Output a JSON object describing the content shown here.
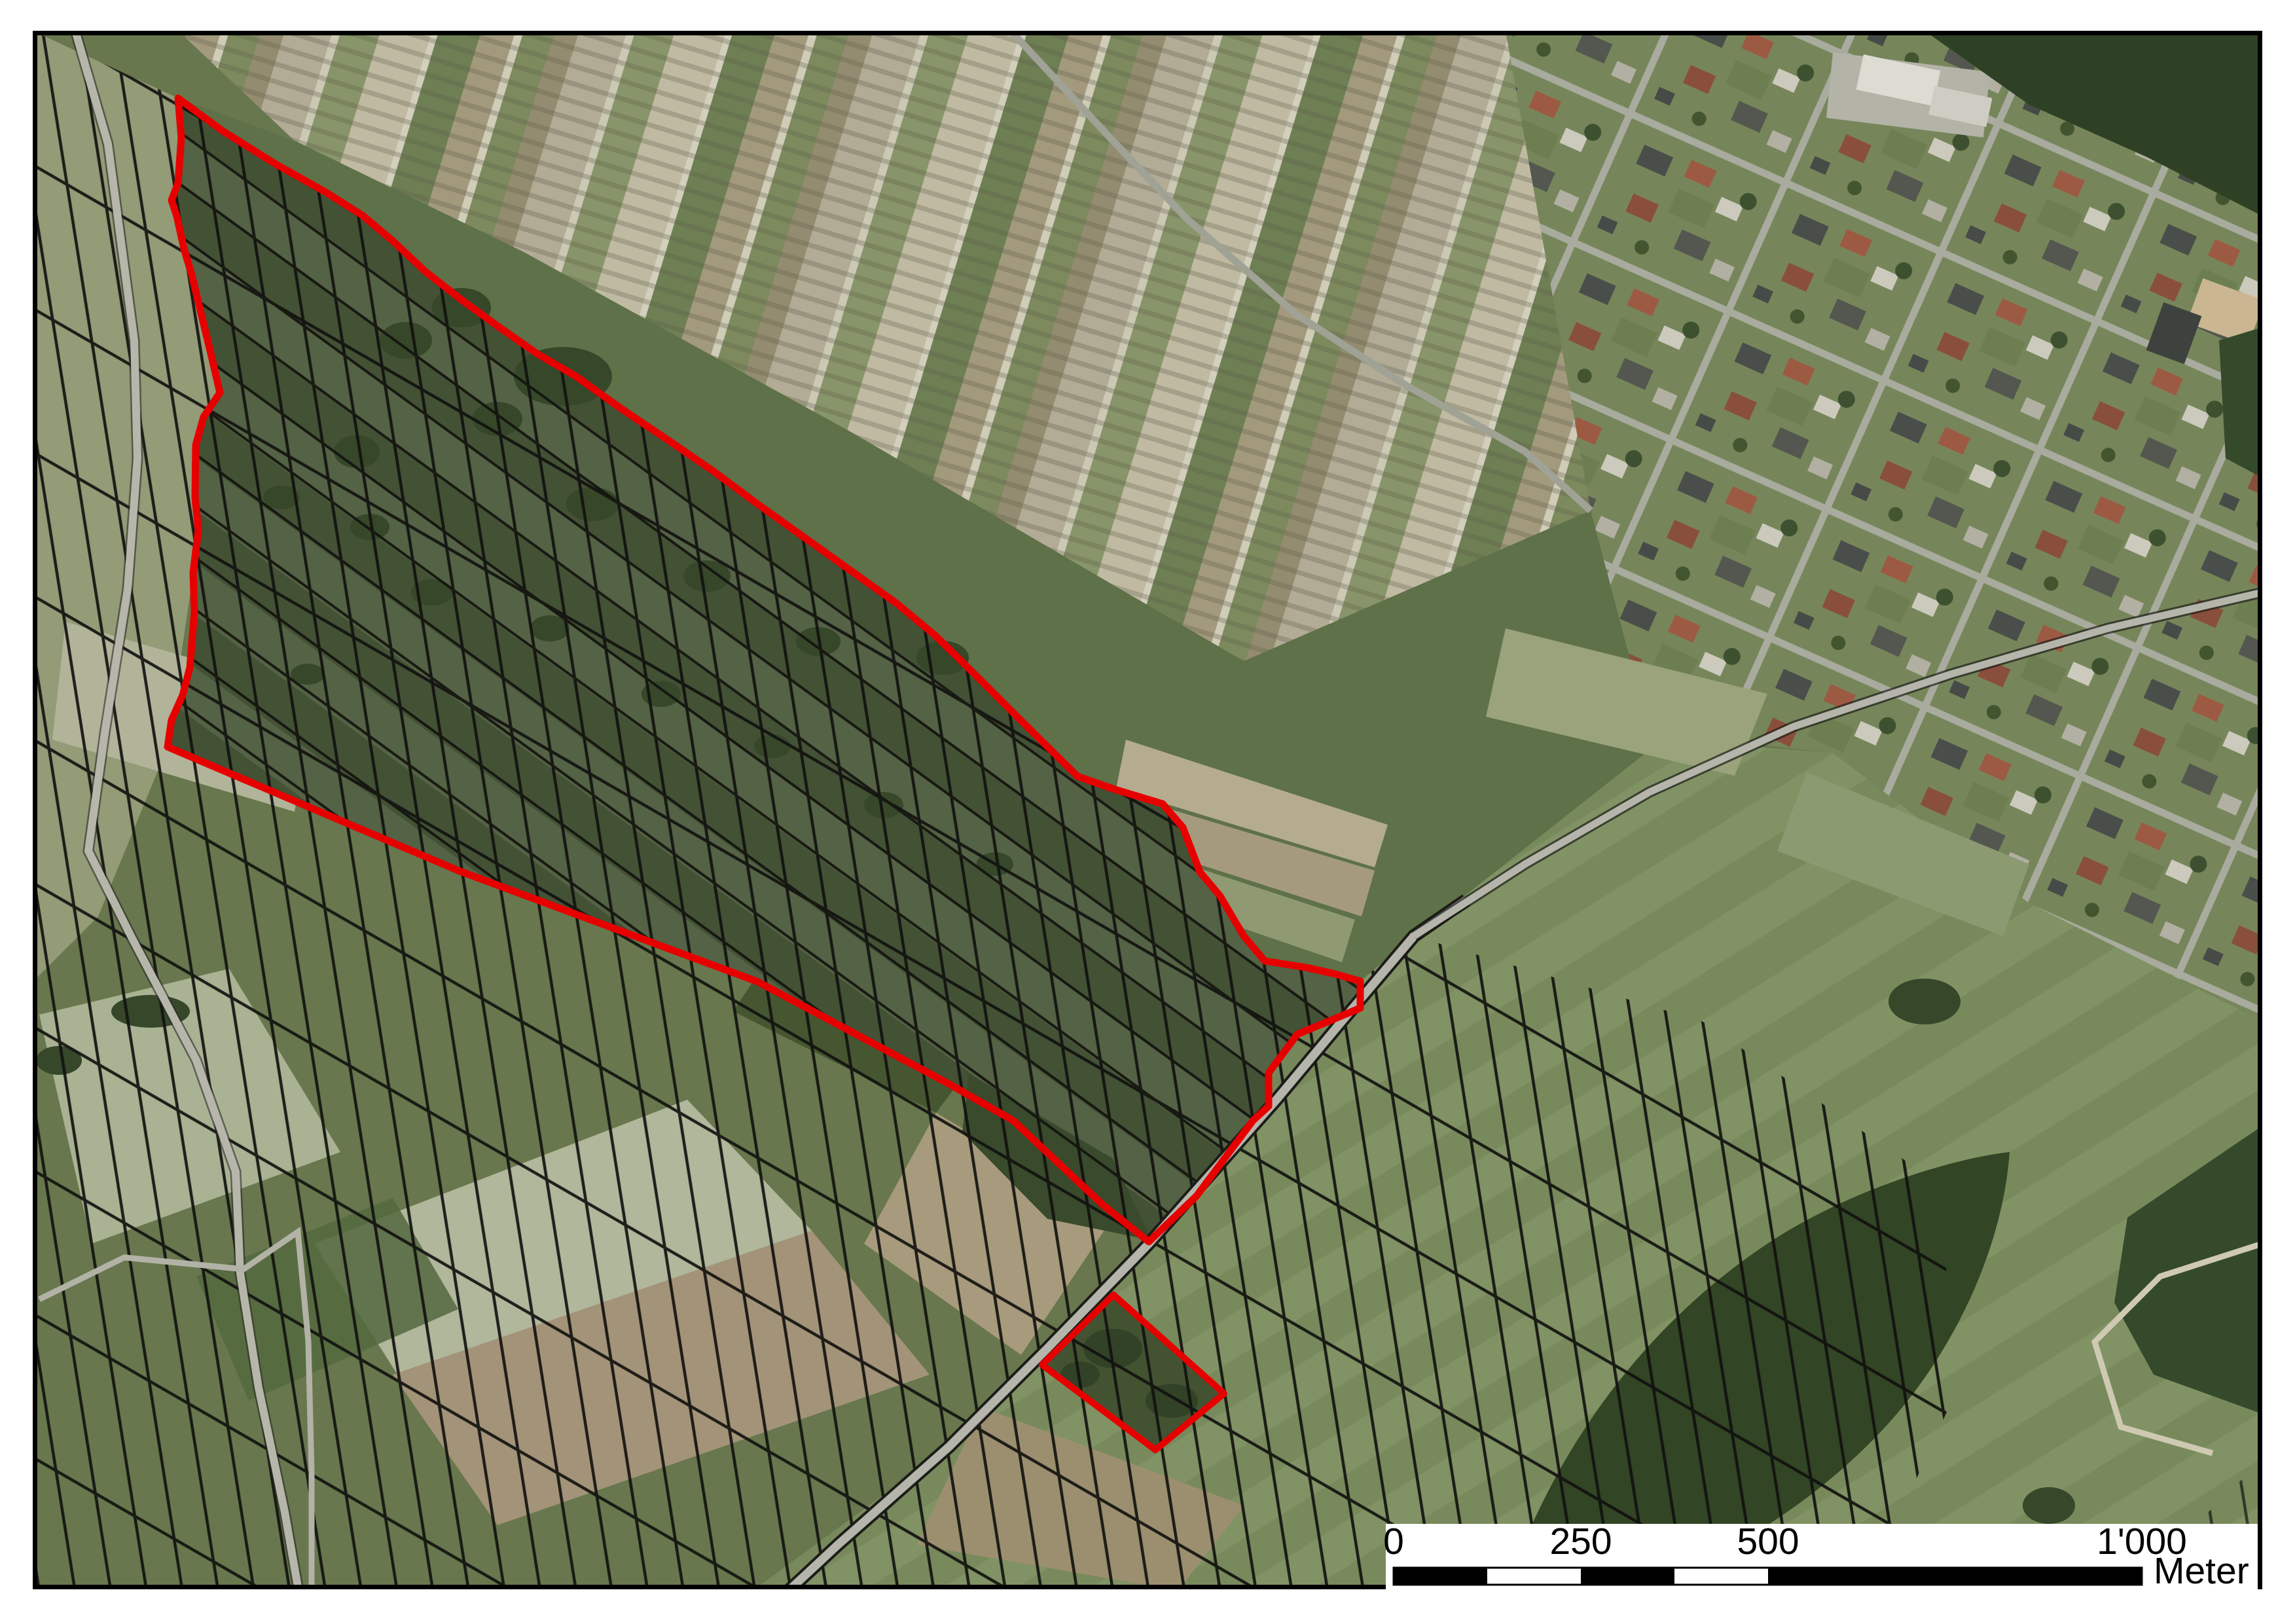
{
  "map": {
    "description": "Aerial orthophoto with cadastral parcel boundaries, village, and red project-area outline",
    "palette": {
      "base_green": "#68774d",
      "riet_dark": "#4b5a3b",
      "pasture": "#5e7148",
      "forest": "#2e4125",
      "town_lawn": "#76865a",
      "road_grey": "#b5b5ac",
      "parcel_line": "#121210",
      "frame": "#000000"
    },
    "overlay": {
      "boundary_color": "#e60000",
      "main_polygon_points": "272,150 340,200 420,250 500,295 555,330 600,368 650,415 705,458 760,498 820,540 880,575 950,625 1020,672 1090,720 1160,772 1230,822 1300,872 1370,922 1430,972 1500,1041 1562,1103 1646,1186 1700,1205 1776,1228 1807,1264 1833,1332 1864,1369 1900,1430 1932,1468 1995,1478 2040,1488 2078,1499 2078,1540 2030,1560 1982,1580 1938,1639 1938,1690 1914,1712 1828,1827 1755,1897 1684,1840 1548,1712 1450,1656 1158,1500 700,1330 256,1141 262,1100 279,1062 290,1020 297,935 295,875 303,810 298,760 299,680 311,637 336,600 322,540 305,470 293,420 281,380 270,330 262,306 268,290 272,280 277,210",
      "detached_polygon_points": "1701,1978 1870,2129 1765,2215 1592,2085"
    }
  },
  "scalebar": {
    "labels": [
      {
        "text": "0"
      },
      {
        "text": "250"
      },
      {
        "text": "500"
      },
      {
        "text": "1'000"
      }
    ],
    "unit": "Meter",
    "tick_values_m": [
      0,
      250,
      500,
      1000
    ]
  }
}
